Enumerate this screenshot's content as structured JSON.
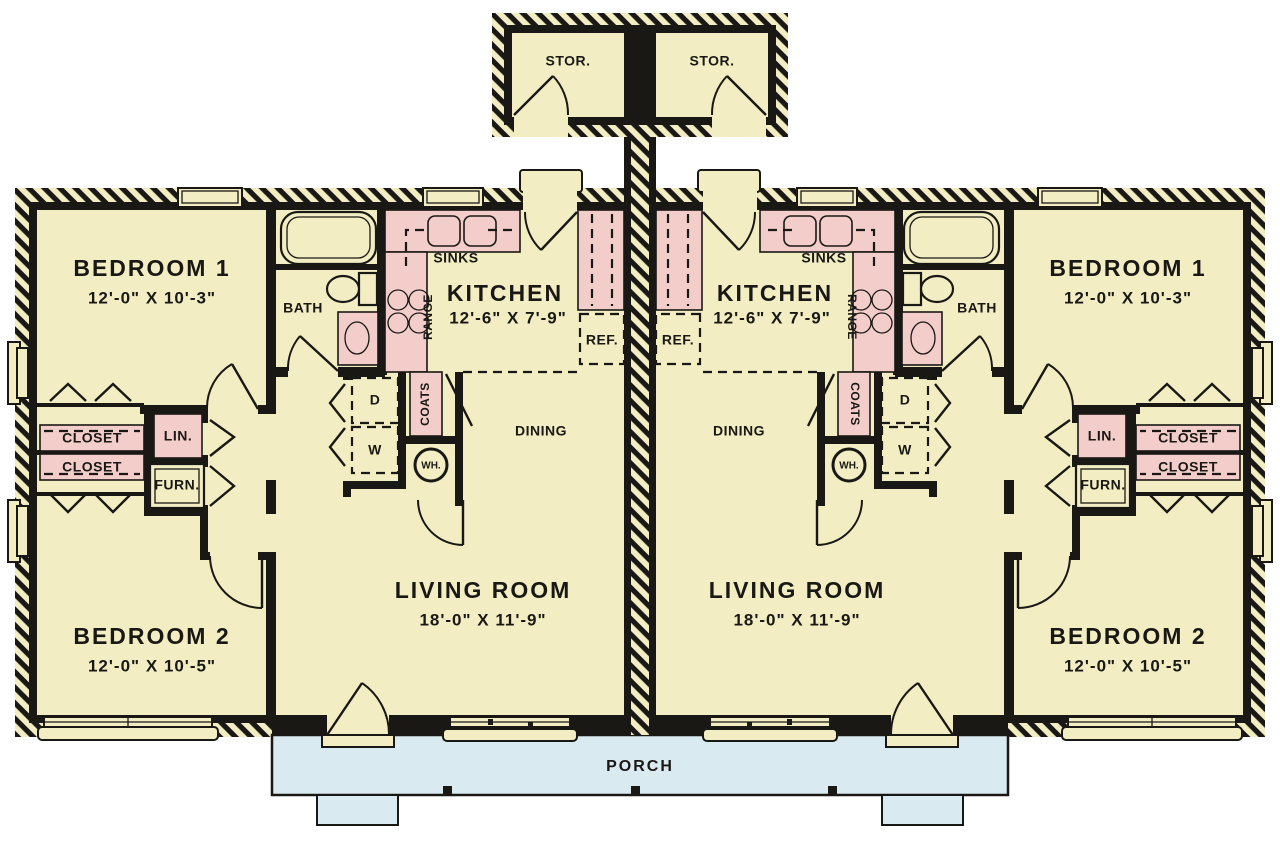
{
  "colors": {
    "background": "#ffffff",
    "floor": "#f2edc3",
    "fixture": "#f3cdca",
    "porch": "#d9eaf1",
    "wall": "#1a1815",
    "window": "#fffef8"
  },
  "storage": {
    "rooms": [
      {
        "label": "STOR."
      },
      {
        "label": "STOR."
      }
    ]
  },
  "porch": {
    "label": "PORCH"
  },
  "units": [
    {
      "side": "left",
      "bedroom1": {
        "name": "BEDROOM 1",
        "dims": "12'-0\" X 10'-3\""
      },
      "bedroom2": {
        "name": "BEDROOM 2",
        "dims": "12'-0\" X 10'-5\""
      },
      "living_room": {
        "name": "LIVING ROOM",
        "dims": "18'-0\" X 11'-9\""
      },
      "kitchen": {
        "name": "KITCHEN",
        "dims": "12'-6\" X 7'-9\""
      },
      "dining": {
        "label": "DINING"
      },
      "bath": {
        "label": "BATH"
      },
      "labels": {
        "sinks": "SINKS",
        "range": "RANGE",
        "refrigerator": "REF.",
        "coats": "COATS",
        "dryer": "D",
        "washer": "W",
        "water_heater": "WH.",
        "linen": "LIN.",
        "furnace": "FURN.",
        "closet_upper": "CLOSET",
        "closet_lower": "CLOSET"
      }
    },
    {
      "side": "right",
      "bedroom1": {
        "name": "BEDROOM 1",
        "dims": "12'-0\" X 10'-3\""
      },
      "bedroom2": {
        "name": "BEDROOM 2",
        "dims": "12'-0\" X 10'-5\""
      },
      "living_room": {
        "name": "LIVING ROOM",
        "dims": "18'-0\" X 11'-9\""
      },
      "kitchen": {
        "name": "KITCHEN",
        "dims": "12'-6\" X 7'-9\""
      },
      "dining": {
        "label": "DINING"
      },
      "bath": {
        "label": "BATH"
      },
      "labels": {
        "sinks": "SINKS",
        "range": "RANGE",
        "refrigerator": "REF.",
        "coats": "COATS",
        "dryer": "D",
        "washer": "W",
        "water_heater": "WH.",
        "linen": "LIN.",
        "furnace": "FURN.",
        "closet_upper": "CLOSET",
        "closet_lower": "CLOSET"
      }
    }
  ]
}
